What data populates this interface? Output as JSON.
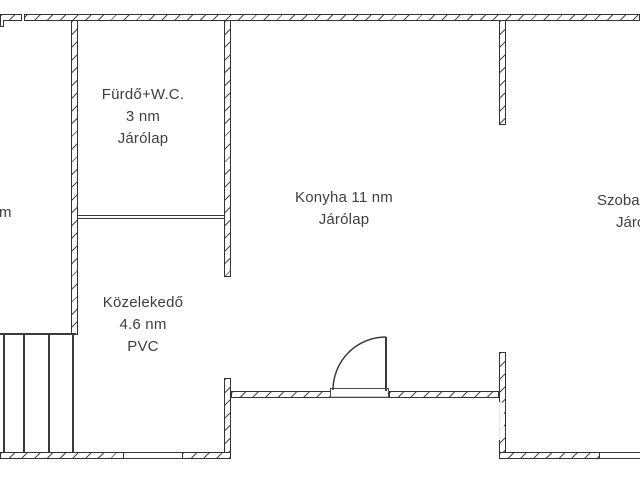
{
  "document": {
    "type": "floor-plan",
    "language": "Hungarian"
  },
  "colors": {
    "background": "#ffffff",
    "wall_line": "#333333",
    "hatch": "#4a4a4a",
    "text": "#3f3f3f"
  },
  "rooms": {
    "left_partial": {
      "lines": [
        "m"
      ]
    },
    "furdo": {
      "lines": [
        "Fürdő+W.C.",
        "3 nm",
        "Járólap"
      ]
    },
    "konyha": {
      "lines": [
        "Konyha 11 nm",
        "Járólap"
      ]
    },
    "szoba": {
      "lines": [
        "Szoba",
        "Járó"
      ]
    },
    "kozlekedo": {
      "lines": [
        "Közelekedő",
        "4.6 nm",
        "PVC"
      ]
    }
  },
  "features": {
    "door": "swing-door-quarter-arc",
    "windows": [
      "bottom-left-window",
      "bottom-right-window"
    ],
    "staircase": "bottom-left-stairs"
  }
}
